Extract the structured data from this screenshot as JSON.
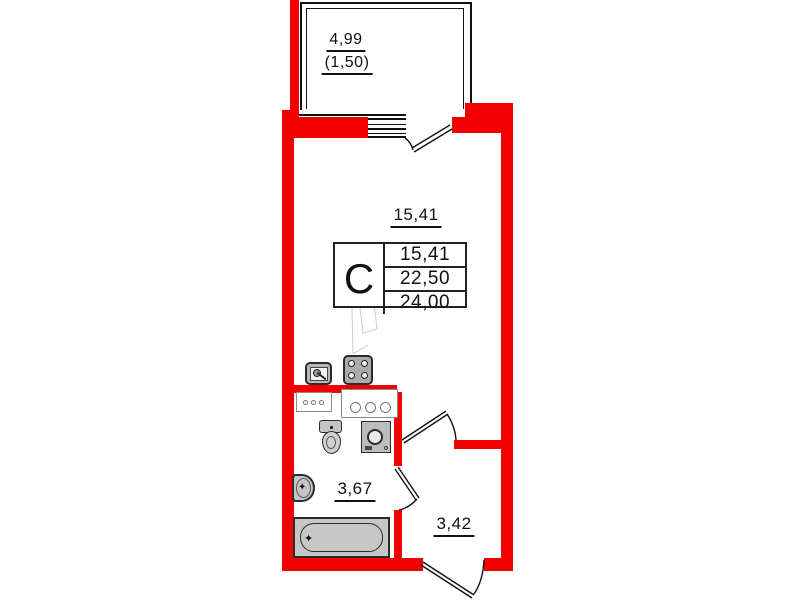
{
  "plan_type": "studio-apartment-floor-plan",
  "colors": {
    "wall_red": "#f20000",
    "line_dark": "#111111",
    "fixture_gray": "#c6c6c6"
  },
  "balcony": {
    "area": "4,99",
    "area_with_coefficient": "(1,50)"
  },
  "rooms": {
    "studio": {
      "area": "15,41"
    },
    "bathroom": {
      "area": "3,67"
    },
    "hallway": {
      "area": "3,42"
    }
  },
  "stamp": {
    "letter": "С",
    "values": [
      "15,41",
      "22,50",
      "24,00"
    ]
  }
}
